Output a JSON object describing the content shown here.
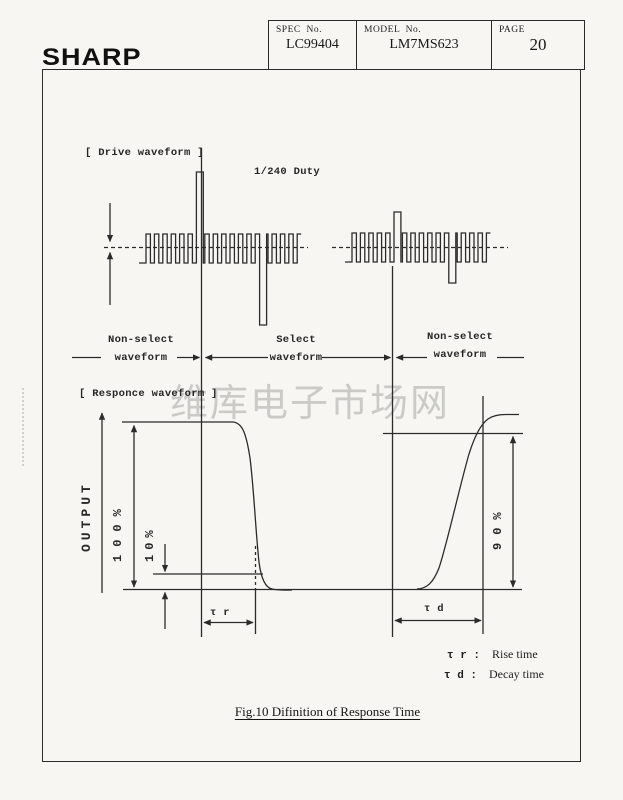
{
  "header": {
    "logo": "SHARP",
    "spec_label": "SPEC  No.",
    "spec_value": "LC99404",
    "model_label": "MODEL  No.",
    "model_value": "LM7MS623",
    "page_label": "PAGE",
    "page_value": "20"
  },
  "figure": {
    "drive_section_label": "[ Drive waveform ]",
    "duty": "1/240 Duty",
    "regions": {
      "left": {
        "line1": "Non-select",
        "line2": "waveform"
      },
      "center": {
        "line1": "Select",
        "line2": "waveform"
      },
      "right": {
        "line1": "Non-select",
        "line2": "waveform"
      }
    },
    "response_section_label": "[ Responce waveform ]",
    "axis_label": "OUTPUT",
    "level_100": "100%",
    "level_10": "10%",
    "level_90": "90%",
    "tau_r": "τ r",
    "tau_d": "τ d",
    "legend": {
      "rise": {
        "symbol": "τ r :",
        "text": "Rise time"
      },
      "decay": {
        "symbol": "τ d :",
        "text": "Decay time"
      }
    },
    "caption": "Fig.10 Difinition of Response Time"
  },
  "watermark": "维库电子市场网"
}
